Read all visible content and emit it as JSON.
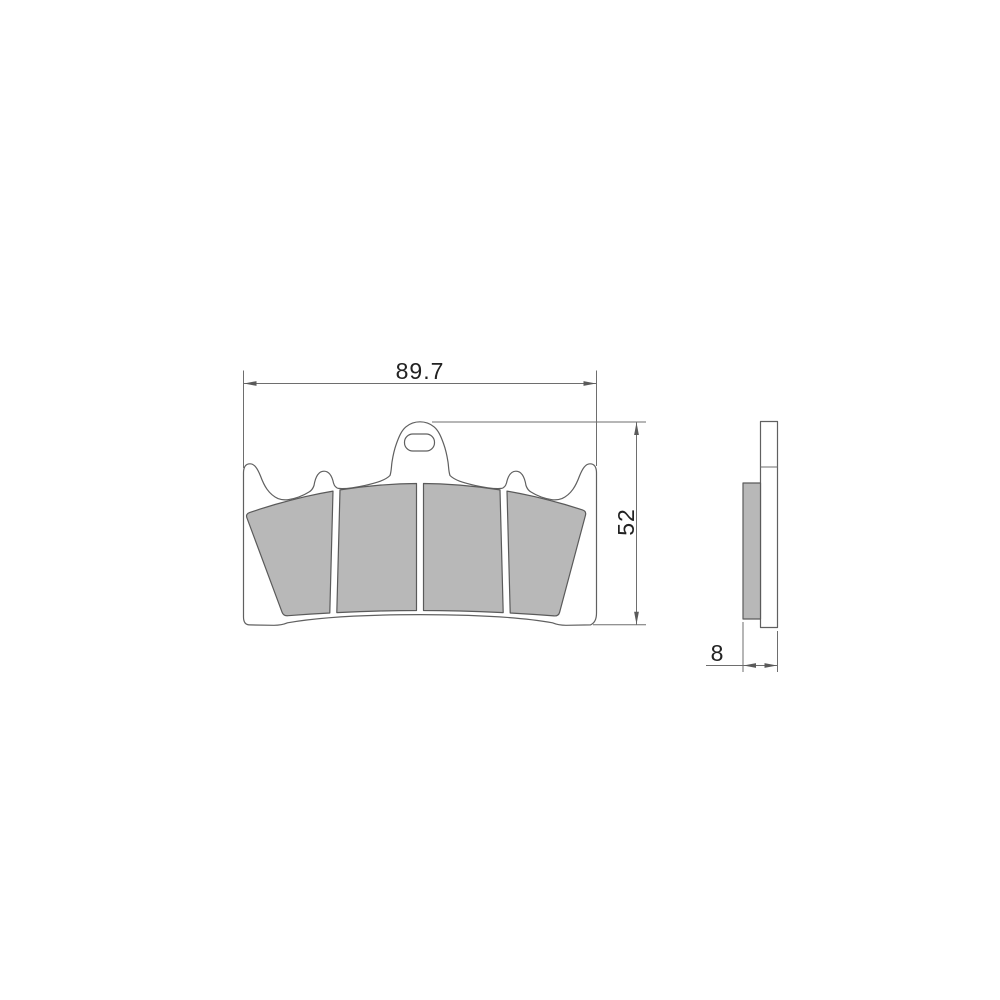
{
  "drawing": {
    "dimensions": {
      "width_mm": "89.7",
      "height_mm": "52",
      "thickness_mm": "8"
    },
    "colors": {
      "line": "#606060",
      "dimension_line": "#6e6e6e",
      "friction_material_fill": "#b8b8b8",
      "plate_fill": "#ffffff",
      "background": "#ffffff",
      "text": "#222222"
    }
  }
}
